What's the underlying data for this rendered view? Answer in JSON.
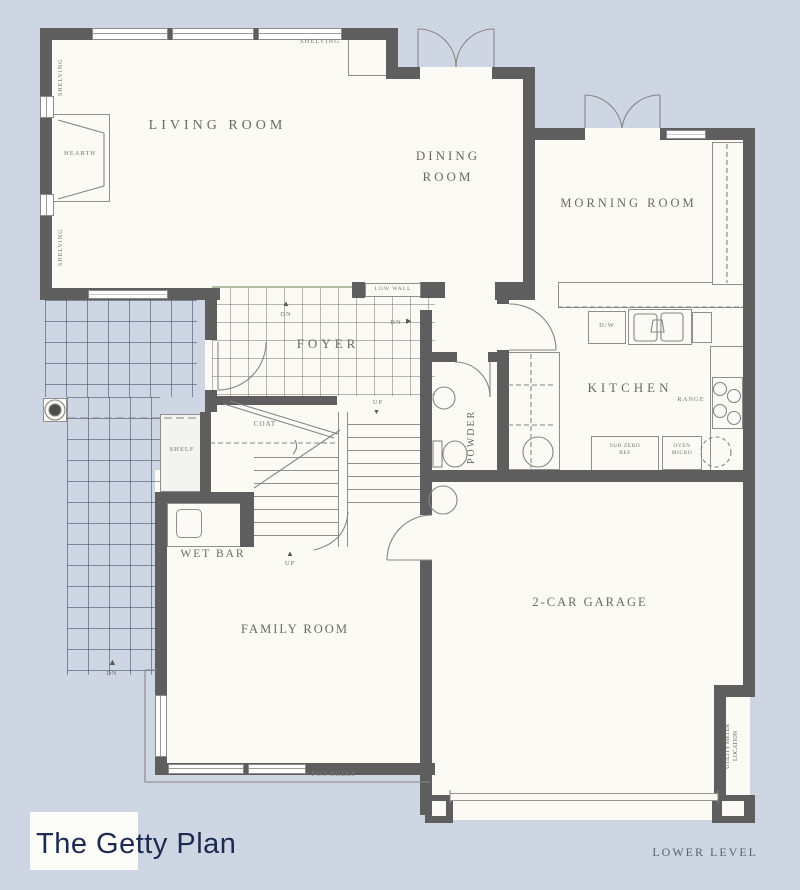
{
  "title": "The Getty Plan",
  "level_label": "LOWER LEVEL",
  "rooms": {
    "living": "LIVING ROOM",
    "dining": "DINING ROOM",
    "morning": "MORNING ROOM",
    "kitchen": "KITCHEN",
    "foyer": "FOYER",
    "powder": "POWDER",
    "wet_bar": "WET BAR",
    "family": "FAMILY ROOM",
    "garage": "2-CAR GARAGE"
  },
  "features": {
    "shelving": "SHELVING",
    "hearth": "HEARTH",
    "low_wall": "LOW WALL",
    "coat": "COAT",
    "shelf": "SHELF",
    "pot_shelf": "POT SHELF",
    "range": "RANGE",
    "dw": "D/W",
    "sub_zero": "SUB ZERO",
    "sub_zero2": "REF",
    "oven": "OVEN",
    "oven2": "MICRO",
    "utility1": "UTILITY METER",
    "utility2": "LOCATION"
  },
  "markers": {
    "dn": "DN",
    "up": "UP"
  },
  "icons": {
    "arrow_up": "▲",
    "arrow_right": "▶",
    "arrow_down": "▼"
  },
  "colors": {
    "background": "#cdd6e2",
    "floor": "#fbfaf5",
    "wall": "#5e5e5e",
    "thin_line": "#858585",
    "title_text": "#1d2b52",
    "label_text": "#6b6b62"
  }
}
